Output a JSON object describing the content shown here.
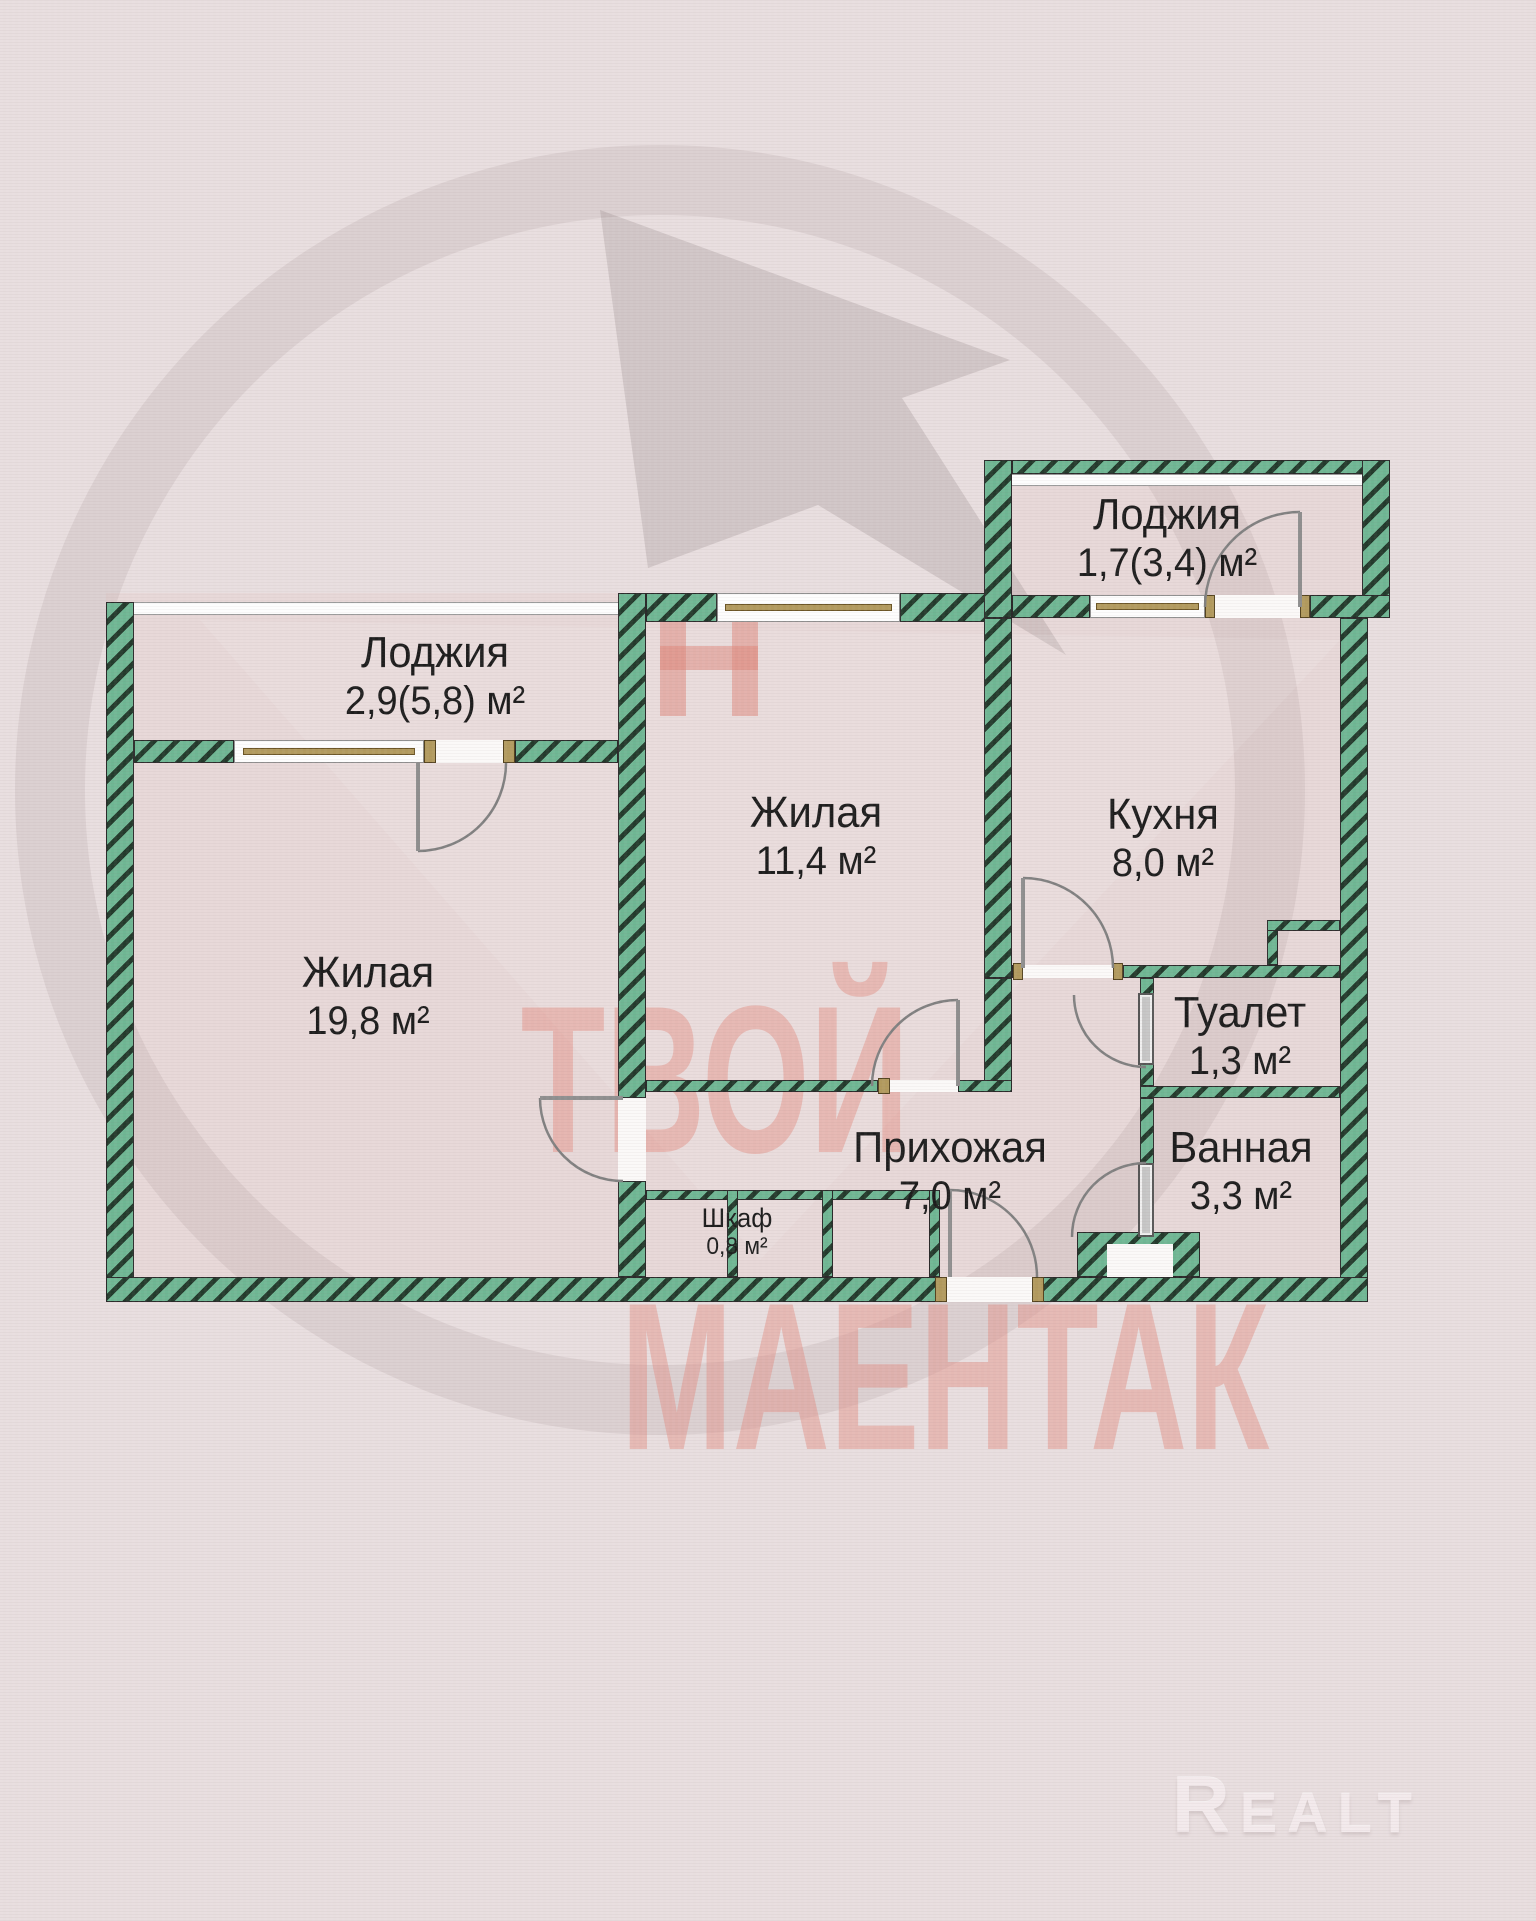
{
  "plan": {
    "rooms": [
      {
        "name": "Лоджия",
        "area": "2,9(5,8) м²"
      },
      {
        "name": "Лоджия",
        "area": "1,7(3,4) м²"
      },
      {
        "name": "Жилая",
        "area": "11,4 м²"
      },
      {
        "name": "Кухня",
        "area": "8,0 м²"
      },
      {
        "name": "Жилая",
        "area": "19,8 м²"
      },
      {
        "name": "Туалет",
        "area": "1,3 м²"
      },
      {
        "name": "Ванная",
        "area": "3,3 м²"
      },
      {
        "name": "Прихожая",
        "area": "7,0 м²"
      },
      {
        "name": "Шкаф",
        "area": "0,8 м²"
      }
    ]
  },
  "watermark": {
    "line1": "ТВОЙ",
    "line2": "МАЕНТАК"
  },
  "brand": {
    "logo_text": "Realt"
  },
  "colors": {
    "wall_green": "#6fb794",
    "wall_hatch": "#233a2c",
    "background": "#e8dedf",
    "floor": "#e7d8d8",
    "label_text": "#1d1d1d",
    "watermark_red": "#dd8377",
    "brand_logo": "#f3eaec",
    "window_frame": "#b29a5e"
  }
}
